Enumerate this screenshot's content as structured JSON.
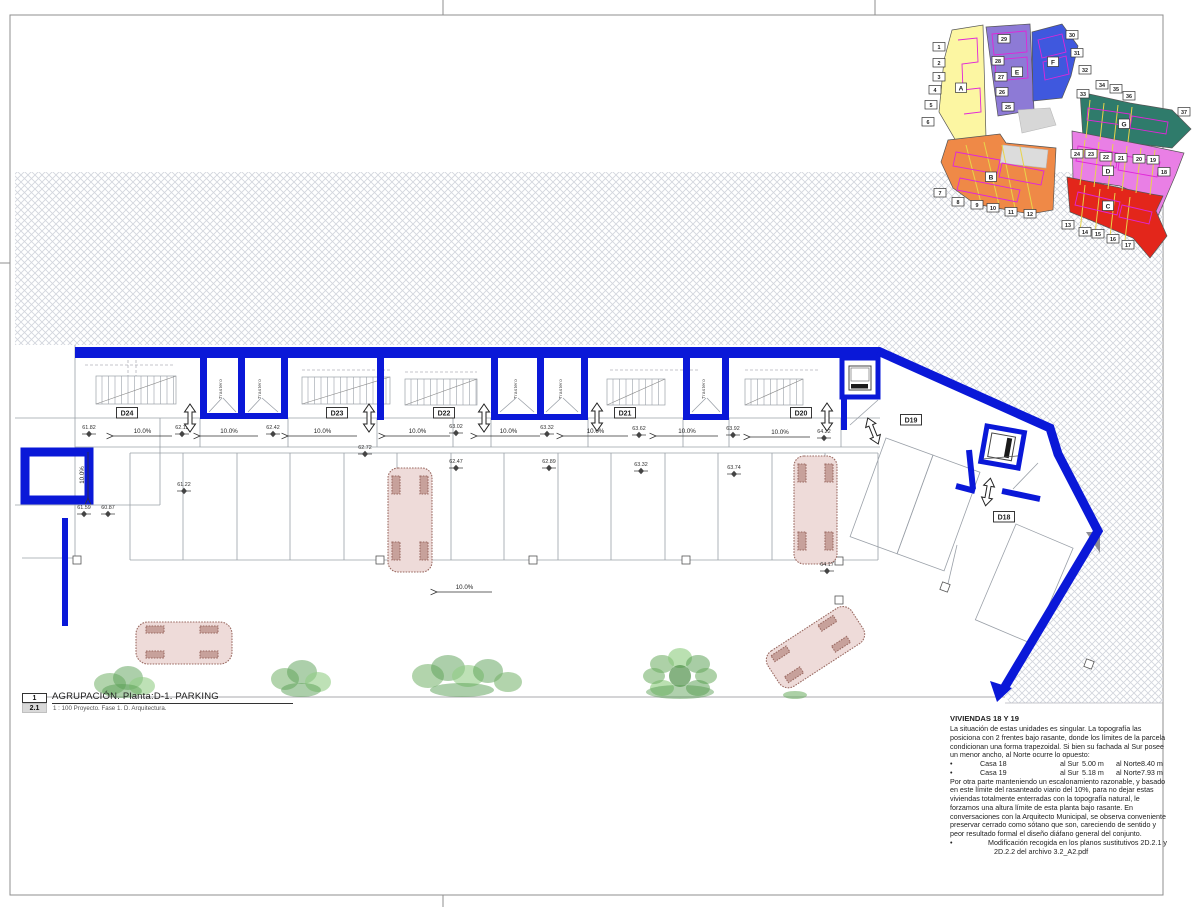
{
  "titleblock": {
    "sheet_no": "1",
    "detail_no": "2.1",
    "title": "AGRUPACIÓN. Planta:D-1. PARKING",
    "scale_line": "1 : 100 Proyecto. Fase 1. D. Arquitectura."
  },
  "notes": {
    "heading": "VIVIENDAS 18 Y 19",
    "para1": [
      "La situación de estas unidades es singular. La topografía las",
      "posiciona con 2 frentes bajo rasante, donde los límites de la parcela",
      "condicionan una forma trapezoidal. Si bien su fachada al Sur posee",
      "un menor ancho, al Norte ocurre lo opuesto:"
    ],
    "casas": [
      {
        "bullet": "•",
        "name": "Casa 18",
        "sur_label": "al Sur",
        "sur": "5.00 m",
        "norte_label": "al Norte",
        "norte": "8.40 m"
      },
      {
        "bullet": "•",
        "name": "Casa 19",
        "sur_label": "al Sur",
        "sur": "5.18 m",
        "norte_label": "al Norte",
        "norte": "7.93 m"
      }
    ],
    "para2": [
      "Por otra parte manteniendo un escalonamiento razonable, y basado",
      "en este límite del rasanteado viario del 10%, para no dejar estas",
      "viviendas totalmente enterradas con la topografía natural, le",
      "forzamos una altura límite de esta planta bajo rasante. En",
      "conversaciones con la Arquitecto Municipal, se observa conveniente",
      "preservar cerrado como sótano que son, careciendo de sentido y",
      "peor resultado formal el diseño diáfano general del conjunto."
    ],
    "bullet2": [
      "Modificación recogida en los planos sustitutivos 2D.2.1 y",
      "2D.2.2 del archivo 3.2_A2.pdf"
    ]
  },
  "plan": {
    "slope_label": "10.0%",
    "trastero_label": "Trastero",
    "unit_labels": [
      {
        "t": "D24",
        "x": 127,
        "y": 413
      },
      {
        "t": "D23",
        "x": 337,
        "y": 413
      },
      {
        "t": "D22",
        "x": 444,
        "y": 413
      },
      {
        "t": "D21",
        "x": 625,
        "y": 413
      },
      {
        "t": "D20",
        "x": 801,
        "y": 413
      },
      {
        "t": "D19",
        "x": 911,
        "y": 420
      },
      {
        "t": "D18",
        "x": 1004,
        "y": 517
      }
    ],
    "slopes": [
      {
        "x1": 113,
        "x2": 172,
        "y": 436
      },
      {
        "x1": 200,
        "x2": 258,
        "y": 436
      },
      {
        "x1": 288,
        "x2": 357,
        "y": 436
      },
      {
        "x1": 385,
        "x2": 450,
        "y": 436
      },
      {
        "x1": 477,
        "x2": 540,
        "y": 436
      },
      {
        "x1": 563,
        "x2": 628,
        "y": 436
      },
      {
        "x1": 656,
        "x2": 718,
        "y": 436
      },
      {
        "x1": 750,
        "x2": 810,
        "y": 437
      },
      {
        "x1": 437,
        "x2": 492,
        "y": 592
      },
      {
        "vertical": true,
        "x": 88,
        "y1": 452,
        "y2": 498
      }
    ],
    "levels": [
      {
        "v": "61.82",
        "x": 89,
        "y": 429
      },
      {
        "v": "62.12",
        "x": 182,
        "y": 429
      },
      {
        "v": "62.42",
        "x": 273,
        "y": 429
      },
      {
        "v": "63.02",
        "x": 456,
        "y": 428
      },
      {
        "v": "63.32",
        "x": 547,
        "y": 429
      },
      {
        "v": "63.62",
        "x": 639,
        "y": 430
      },
      {
        "v": "63.92",
        "x": 733,
        "y": 430
      },
      {
        "v": "64.22",
        "x": 824,
        "y": 433
      },
      {
        "v": "62.72",
        "x": 365,
        "y": 449
      },
      {
        "v": "61.22",
        "x": 184,
        "y": 486
      },
      {
        "v": "62.47",
        "x": 456,
        "y": 463
      },
      {
        "v": "62.89",
        "x": 549,
        "y": 463
      },
      {
        "v": "63.32",
        "x": 641,
        "y": 466
      },
      {
        "v": "63.74",
        "x": 734,
        "y": 469
      },
      {
        "v": "64.17",
        "x": 827,
        "y": 566
      },
      {
        "v": "61.59",
        "x": 84,
        "y": 509
      },
      {
        "v": "60.87",
        "x": 108,
        "y": 509
      }
    ],
    "trasteros": [
      {
        "x": 222,
        "y": 389
      },
      {
        "x": 261,
        "y": 389
      },
      {
        "x": 517,
        "y": 389
      },
      {
        "x": 562,
        "y": 389
      },
      {
        "x": 705,
        "y": 389
      }
    ],
    "doors": [
      {
        "x": 190,
        "y": 418,
        "r": 0
      },
      {
        "x": 369,
        "y": 418,
        "r": 0
      },
      {
        "x": 484,
        "y": 418,
        "r": 0
      },
      {
        "x": 597,
        "y": 417,
        "r": 0
      },
      {
        "x": 827,
        "y": 417,
        "r": 0
      },
      {
        "x": 873,
        "y": 431,
        "r": -22
      },
      {
        "x": 988,
        "y": 492,
        "r": 10
      }
    ]
  },
  "keymap": {
    "zones": [
      {
        "t": "A",
        "color": "#fcf6a2",
        "points": "952,30 983,25 986,138 956,141 939,112 944,60",
        "lx": 961,
        "ly": 88
      },
      {
        "t": "E",
        "color": "#8d7ad6",
        "points": "986,27 1030,24 1034,110 998,116",
        "lx": 1017,
        "ly": 72
      },
      {
        "t": "F",
        "color": "#3f58de",
        "points": "1032,32 1062,24 1078,46 1071,76 1062,98 1033,101",
        "lx": 1053,
        "ly": 62
      },
      {
        "t": "G",
        "color": "#2f7b6b",
        "points": "1080,92 1130,103 1172,110 1191,129 1172,148 1120,142 1083,138",
        "lx": 1124,
        "ly": 124
      },
      {
        "t": "D",
        "color": "#e97fe5",
        "points": "1072,131 1150,146 1184,153 1176,174 1158,216 1143,196 1120,186 1073,179",
        "lx": 1108,
        "ly": 171
      },
      {
        "t": "B",
        "color": "#ef8947",
        "points": "948,140 1000,134 1006,143 1056,148 1053,210 1030,214 975,204 953,188 941,162",
        "lx": 991,
        "ly": 177
      },
      {
        "t": "C",
        "color": "#e3261b",
        "points": "1067,177 1151,194 1163,196 1156,211 1167,236 1150,258 1133,238 1090,220 1070,212",
        "lx": 1108,
        "ly": 206
      }
    ],
    "numbers": [
      {
        "n": "1",
        "x": 939,
        "y": 47
      },
      {
        "n": "2",
        "x": 939,
        "y": 63
      },
      {
        "n": "3",
        "x": 939,
        "y": 77
      },
      {
        "n": "4",
        "x": 935,
        "y": 90
      },
      {
        "n": "5",
        "x": 931,
        "y": 105
      },
      {
        "n": "6",
        "x": 928,
        "y": 122
      },
      {
        "n": "7",
        "x": 940,
        "y": 193
      },
      {
        "n": "8",
        "x": 958,
        "y": 202
      },
      {
        "n": "9",
        "x": 977,
        "y": 205
      },
      {
        "n": "10",
        "x": 993,
        "y": 208
      },
      {
        "n": "11",
        "x": 1011,
        "y": 212
      },
      {
        "n": "12",
        "x": 1030,
        "y": 214
      },
      {
        "n": "13",
        "x": 1068,
        "y": 225
      },
      {
        "n": "14",
        "x": 1085,
        "y": 232
      },
      {
        "n": "15",
        "x": 1098,
        "y": 234
      },
      {
        "n": "16",
        "x": 1113,
        "y": 239
      },
      {
        "n": "17",
        "x": 1128,
        "y": 245
      },
      {
        "n": "18",
        "x": 1164,
        "y": 172
      },
      {
        "n": "19",
        "x": 1153,
        "y": 160
      },
      {
        "n": "20",
        "x": 1139,
        "y": 159
      },
      {
        "n": "21",
        "x": 1121,
        "y": 158
      },
      {
        "n": "22",
        "x": 1106,
        "y": 157
      },
      {
        "n": "23",
        "x": 1091,
        "y": 154
      },
      {
        "n": "24",
        "x": 1077,
        "y": 154
      },
      {
        "n": "25",
        "x": 1008,
        "y": 107
      },
      {
        "n": "26",
        "x": 1002,
        "y": 92
      },
      {
        "n": "27",
        "x": 1001,
        "y": 77
      },
      {
        "n": "28",
        "x": 998,
        "y": 61
      },
      {
        "n": "29",
        "x": 1004,
        "y": 39
      },
      {
        "n": "30",
        "x": 1072,
        "y": 35
      },
      {
        "n": "31",
        "x": 1077,
        "y": 53
      },
      {
        "n": "32",
        "x": 1085,
        "y": 70
      },
      {
        "n": "33",
        "x": 1083,
        "y": 94
      },
      {
        "n": "34",
        "x": 1102,
        "y": 85
      },
      {
        "n": "35",
        "x": 1116,
        "y": 89
      },
      {
        "n": "36",
        "x": 1129,
        "y": 96
      },
      {
        "n": "37",
        "x": 1184,
        "y": 112
      }
    ]
  },
  "colors": {
    "wall_blue": "#0a18d8",
    "line_gray": "#9aa0a8",
    "hatch": "#d3d6dd",
    "car_fill": "#eedbd9",
    "car_stroke": "#9b6b63",
    "tree_green_dark": "#3e8f38",
    "tree_green_mid": "#5aa34d",
    "tree_green_light": "#7fc470"
  }
}
